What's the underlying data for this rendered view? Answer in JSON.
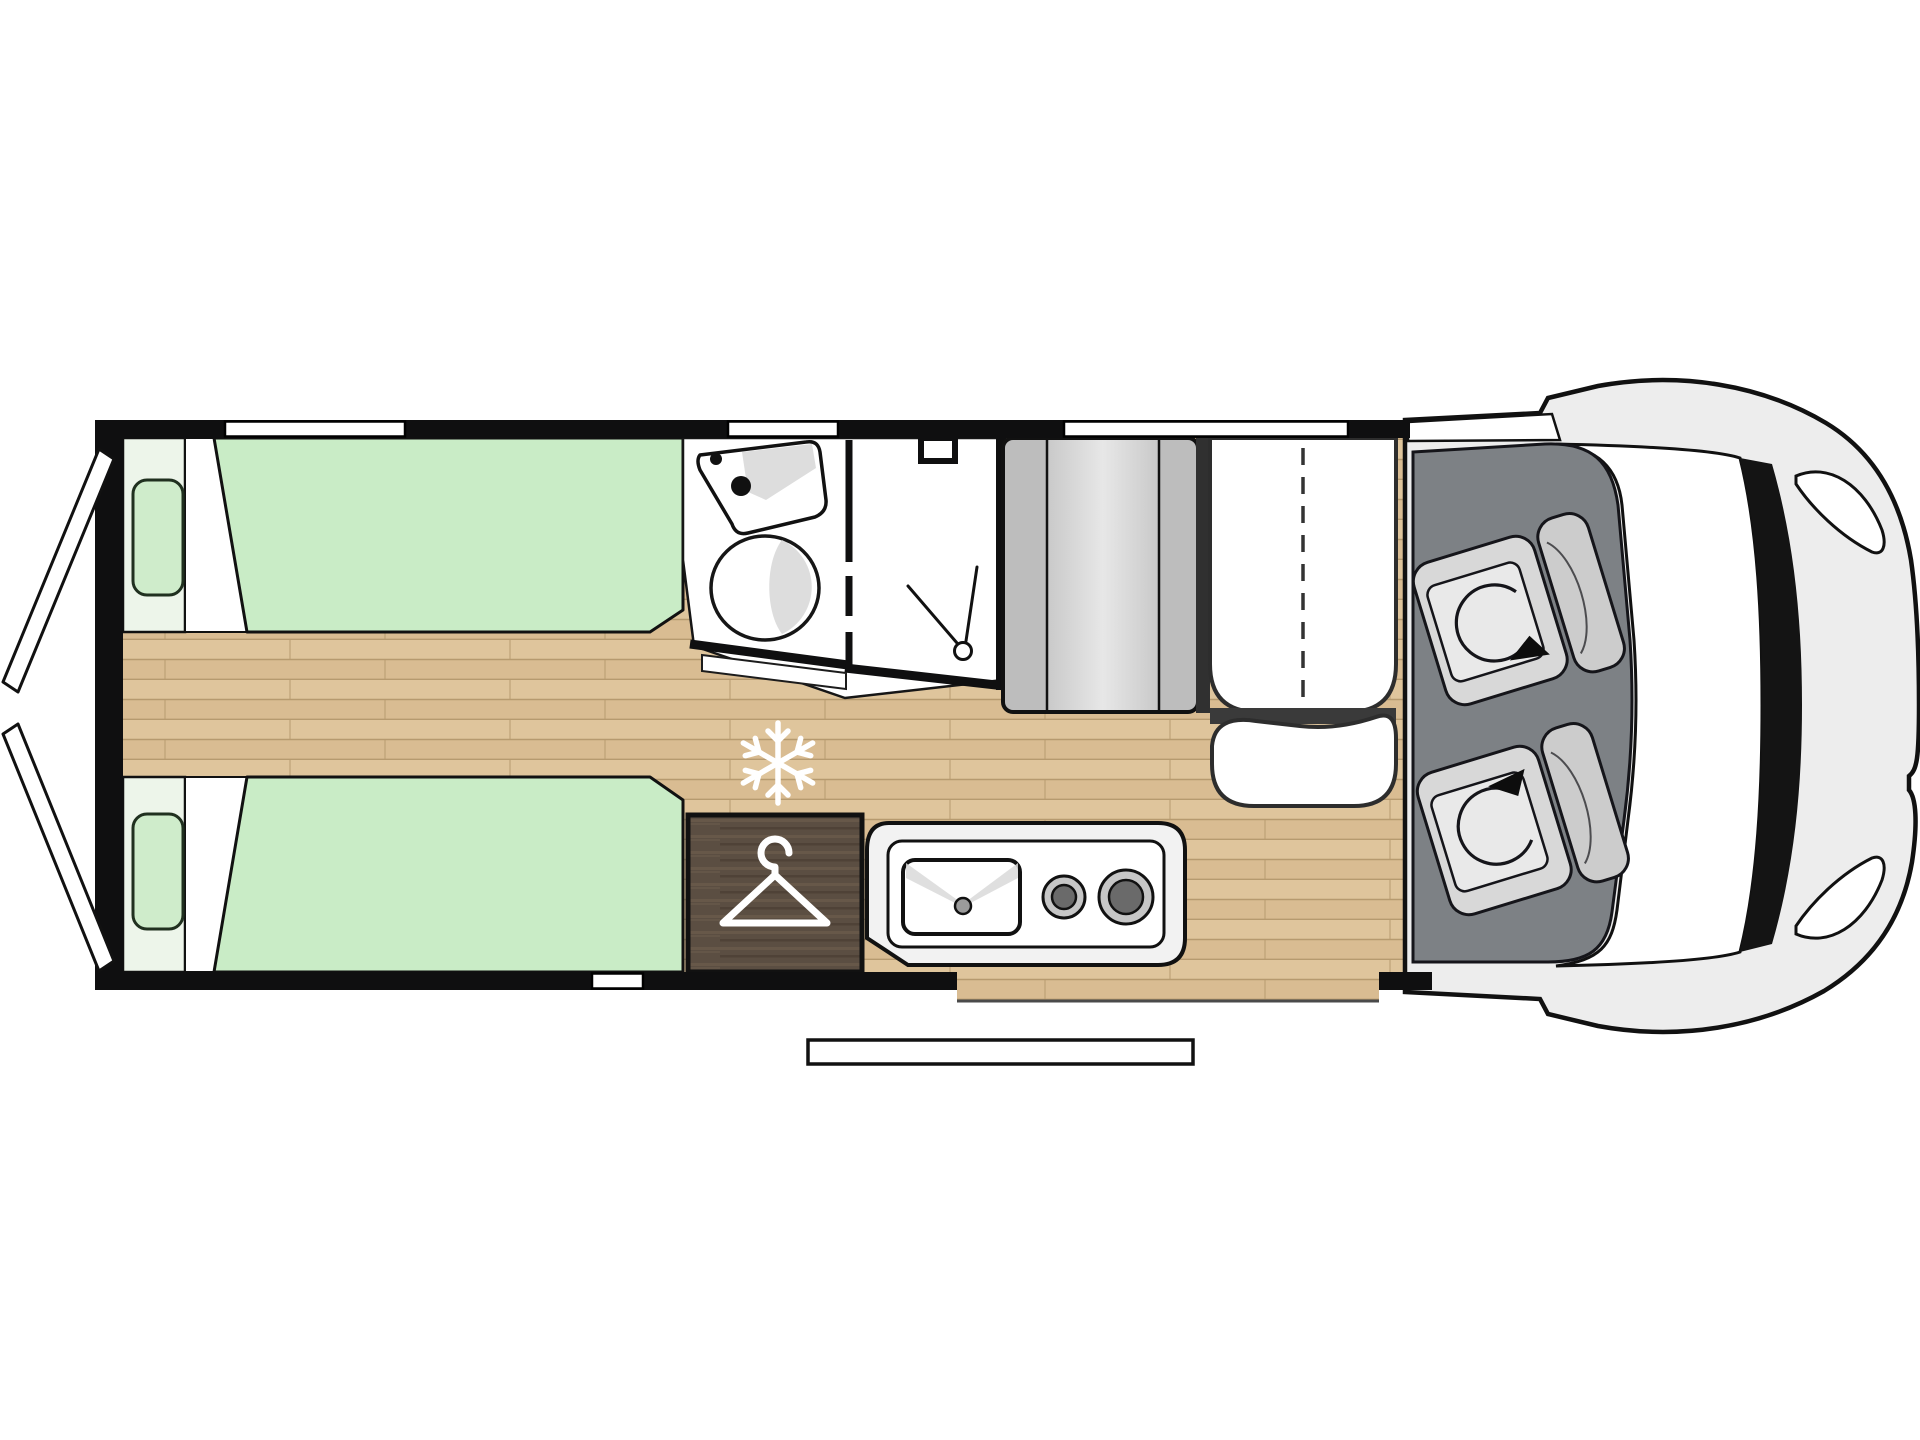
{
  "diagram": {
    "title": "motorhome-floorplan-top-view",
    "type": "van conversion camper floor plan",
    "zones": [
      {
        "id": "rear-doors",
        "desc": "rear barn doors shown open"
      },
      {
        "id": "single-bed-top",
        "desc": "longitudinal single bed with pillow"
      },
      {
        "id": "single-bed-bottom",
        "desc": "longitudinal single bed with pillow"
      },
      {
        "id": "center-walkway",
        "desc": "wood floor aisle between beds"
      },
      {
        "id": "washroom",
        "desc": "bathroom with corner sink and toilet"
      },
      {
        "id": "shower",
        "desc": "shower cubicle with folding door"
      },
      {
        "id": "tall-cabinet",
        "desc": "gray cabinet tower beside washroom"
      },
      {
        "id": "travel-bench",
        "desc": "two-place belted bench seat"
      },
      {
        "id": "dinette-table",
        "desc": "table in front of bench"
      },
      {
        "id": "wardrobe",
        "desc": "dark wood wardrobe marked with hanger"
      },
      {
        "id": "kitchen-block",
        "desc": "kitchen with sink and two burners"
      },
      {
        "id": "fridge-position",
        "desc": "snowflake mark on floor"
      },
      {
        "id": "entrance-step",
        "desc": "exterior sliding-door step"
      },
      {
        "id": "cab",
        "desc": "driver cab with two swivel seats"
      },
      {
        "id": "vehicle-front",
        "desc": "windshield, pillars, hood, headlights"
      }
    ],
    "icons": {
      "snowflake": "snowflake-icon",
      "hanger": "hanger-icon",
      "shower_head": "shower-head-icon",
      "swivel_arrows": "rotate-arrow-icon"
    }
  },
  "colors": {
    "wall": "#0f0f10",
    "window": "#ffffff",
    "woodBase": "#d9bc92",
    "woodBand": "#e3cba3",
    "woodSeam": "#b69a6f",
    "bedBase": "#edf5ea",
    "bedGreen": "#c9ecc6",
    "pillowGreen": "#cfeccb",
    "sheetWhite": "#ffffff",
    "bathWhite": "#ffffff",
    "fixtureShade": "#d9d9d9",
    "cabinetSide": "#bdbdbd",
    "cabinetLight": "#e7e7e7",
    "cabinetMid": "#c9c9c9",
    "benchWhite": "#ffffff",
    "wardrobeBase": "#5b4e42",
    "wardrobeStreakLight": "#71614f",
    "wardrobeStreakDark": "#473b31",
    "kitchenOuter": "#f2f2f2",
    "burnerRing": "#c6c6c6",
    "burnerCenter": "#6a6a6a",
    "sinkDot": "#9b9b9b",
    "iconWhite": "#ffffff",
    "cabFloor": "#7d8185",
    "seatBase": "#d8d8d8",
    "seatInner": "#e9e9e9",
    "seatBack": "#cccccc",
    "bodyGray": "#ededed",
    "pillarBlack": "#141414",
    "stepWhite": "#ffffff",
    "gapDark": "#303030"
  }
}
